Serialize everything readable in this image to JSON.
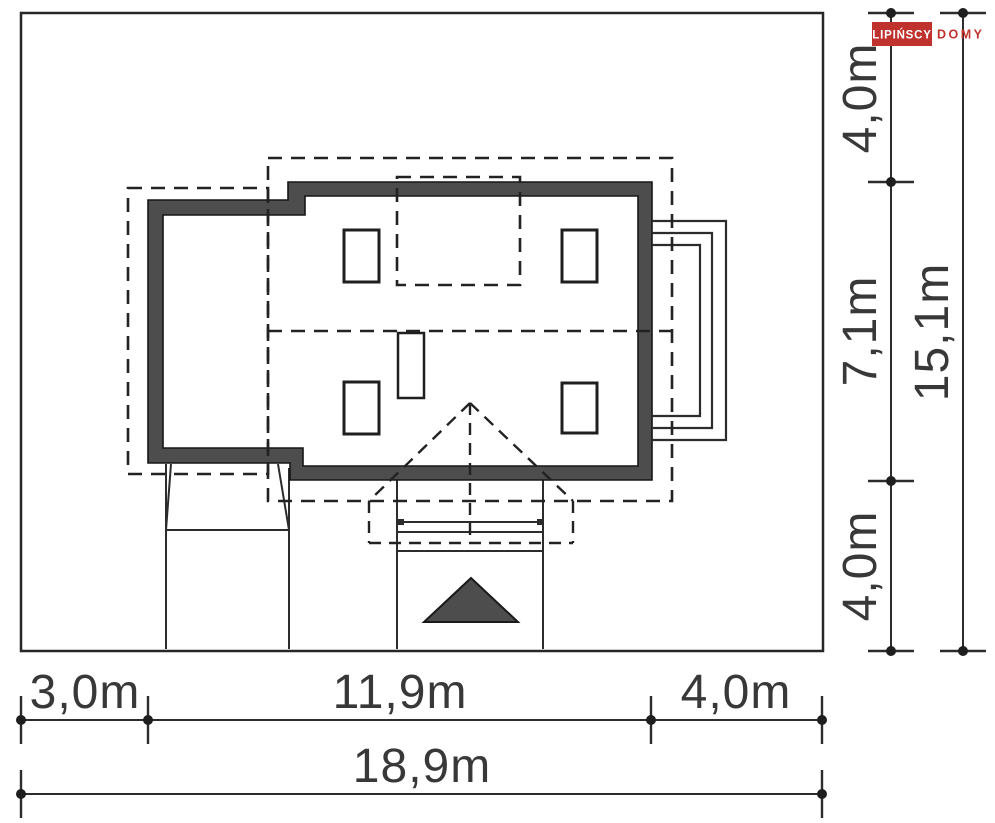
{
  "logo": {
    "primary": "LIPIŃSCY",
    "secondary": "DOMY"
  },
  "dimensions": {
    "right_top": "4,0m",
    "right_middle": "7,1m",
    "right_bottom": "4,0m",
    "right_total": "15,1m",
    "bottom_left": "3,0m",
    "bottom_middle": "11,9m",
    "bottom_right": "4,0m",
    "bottom_total": "18,9m"
  },
  "colors": {
    "background": "#ffffff",
    "wall_fill": "#4d4d4d",
    "line_dark": "#2c2c2c",
    "text": "#383838",
    "accent_red": "#c0322d"
  }
}
